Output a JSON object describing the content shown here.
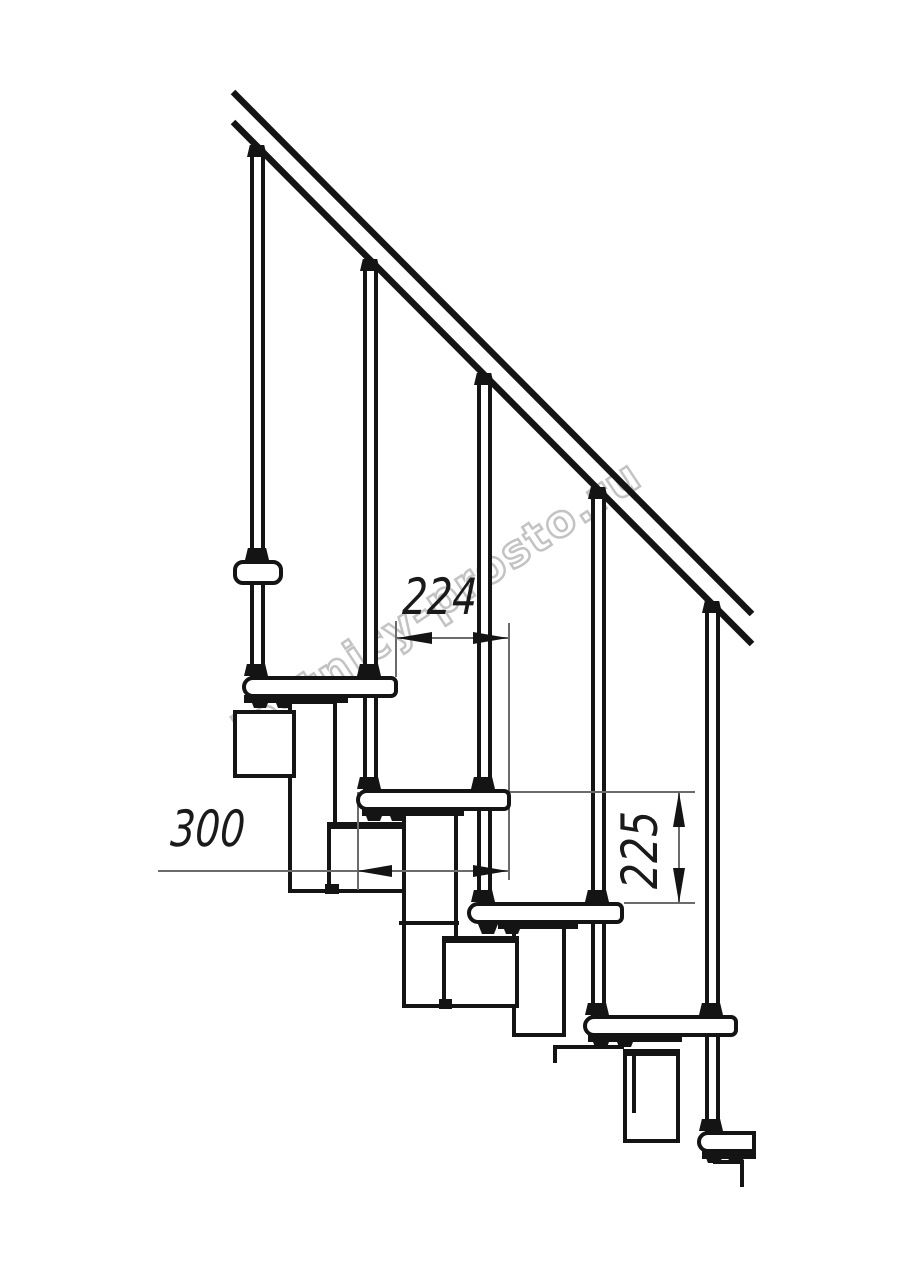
{
  "watermark": {
    "text": "lestnicy-prosto.ru"
  },
  "dimensions": {
    "tread_run": {
      "label": "224",
      "orientation": "horizontal"
    },
    "tread_depth": {
      "label": "300",
      "orientation": "horizontal"
    },
    "riser_height": {
      "label": "225",
      "orientation": "vertical"
    }
  },
  "colors": {
    "line": "#141414",
    "dimension_line": "#6b6b6b",
    "watermark": "#c3c3c3",
    "background": "#ffffff"
  }
}
